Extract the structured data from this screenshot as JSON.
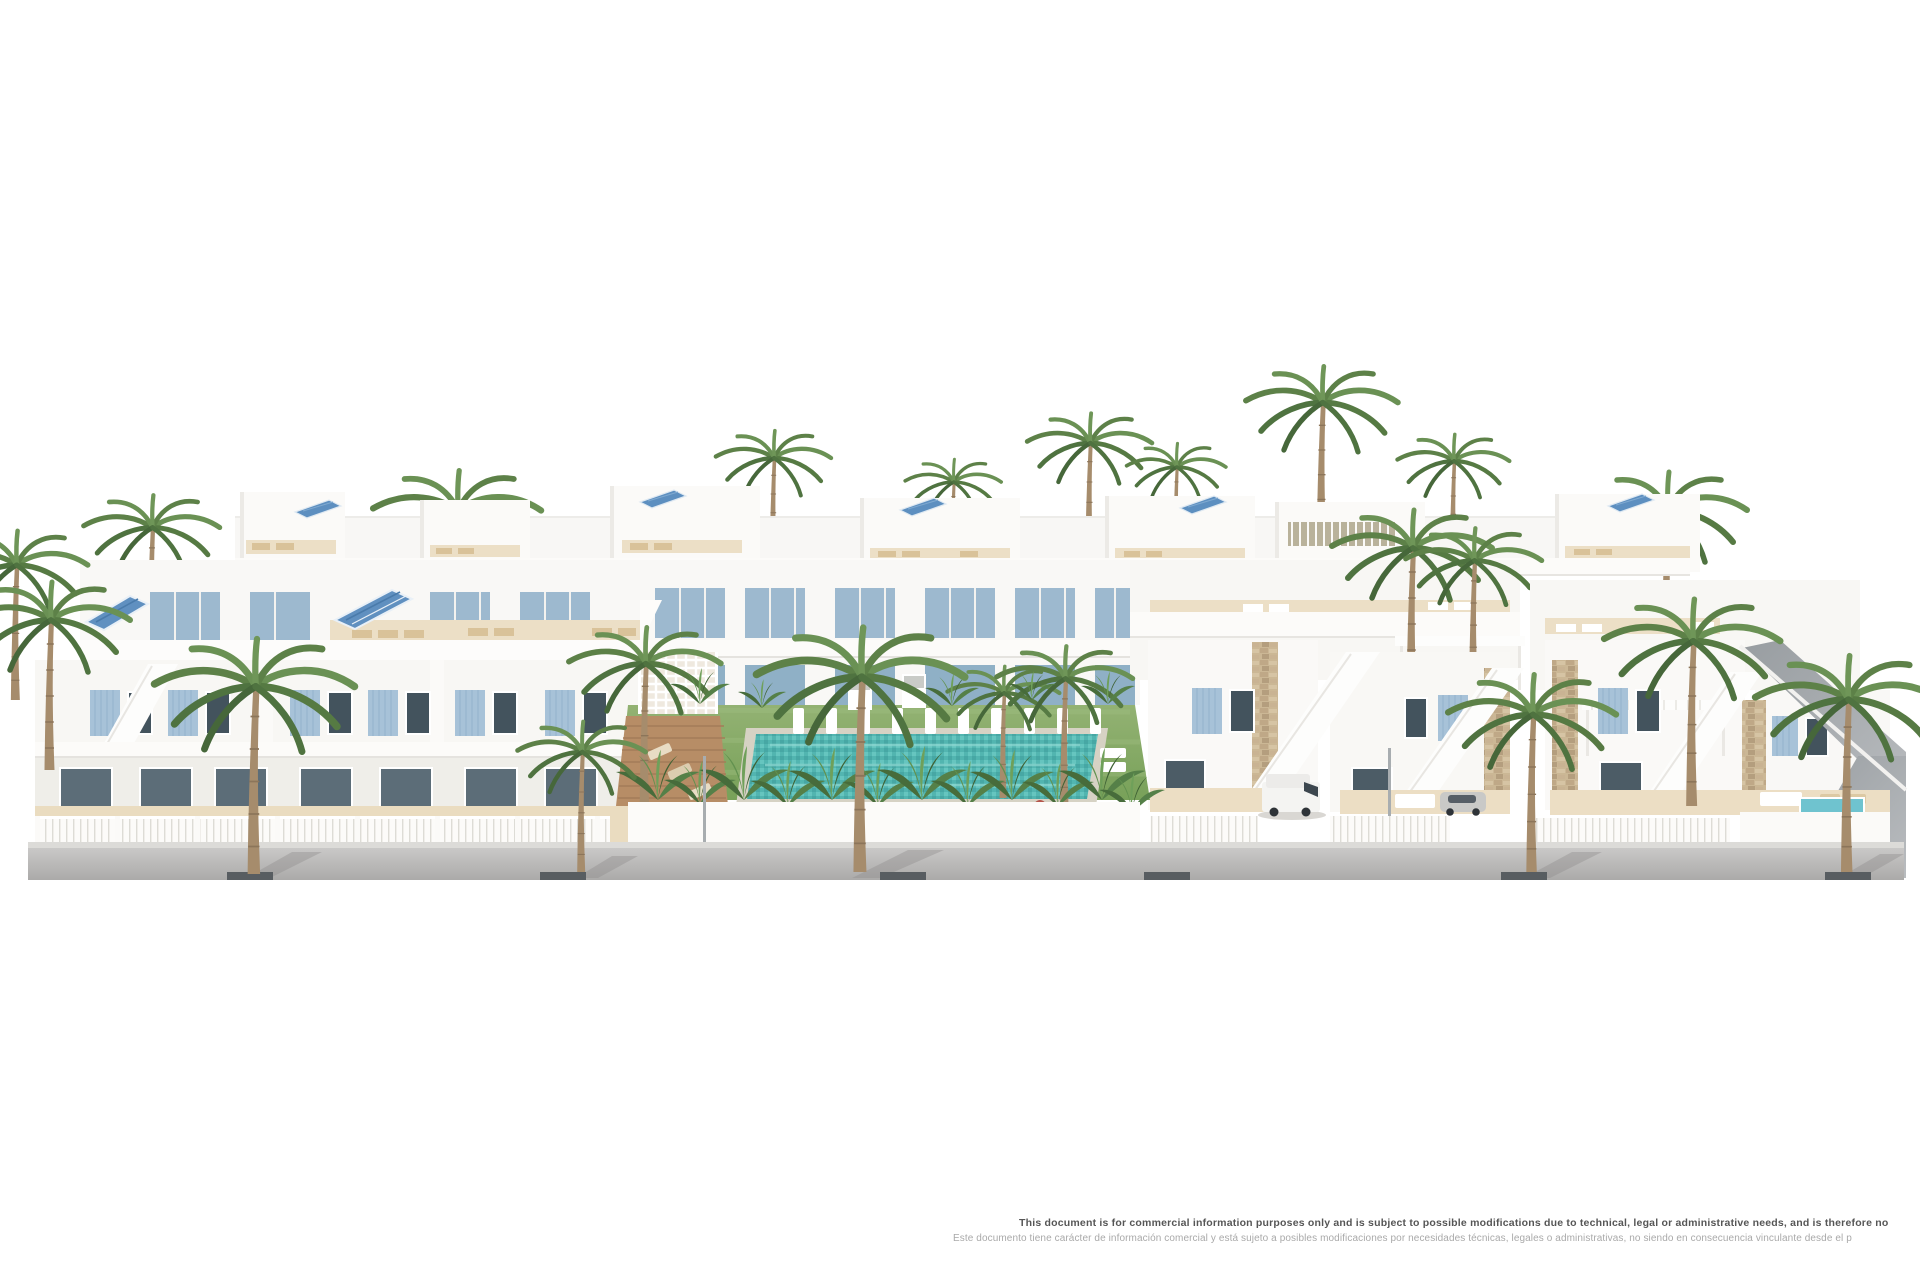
{
  "disclaimer": {
    "en": "This document is for commercial information purposes only and is subject to possible modifications due to technical, legal or administrative needs, and is therefore no",
    "es": "Este documento tiene carácter de información comercial y está sujeto a posibles modificaciones por necesidades técnicas, legales o administrativas, no siendo en consecuencia vinculante desde el p"
  },
  "scene": {
    "type": "architectural-3d-render",
    "subject": "Residential development render: white Mediterranean apartments and villas with light-blue shutters, rooftop terraces with sun loungers and solar panels, communal garden with turquoise pool and white sun beds, tropical plants and palm trees, white street wall and slatted fences, grey road with kerb drains, white van and parked car",
    "palette": {
      "background": "#ffffff",
      "building_white": "#f8f7f4",
      "building_shadow": "#e5e3de",
      "shutter_blue": "#a7c2d8",
      "glazing_blue": "#9db9cf",
      "solar_blue": "#5d8fc0",
      "pool_teal": "#52b5b0",
      "lawn_green": "#83a863",
      "palm_green": "#5d8148",
      "terrace_beige": "#eadcc0",
      "deck_wood": "#b78d66",
      "stone_tan": "#cbb795",
      "road_grey": "#bcbbba",
      "kerb_marker_dark": "#585d61",
      "text_dark": "#565656",
      "text_light": "#a9a9a9"
    }
  }
}
